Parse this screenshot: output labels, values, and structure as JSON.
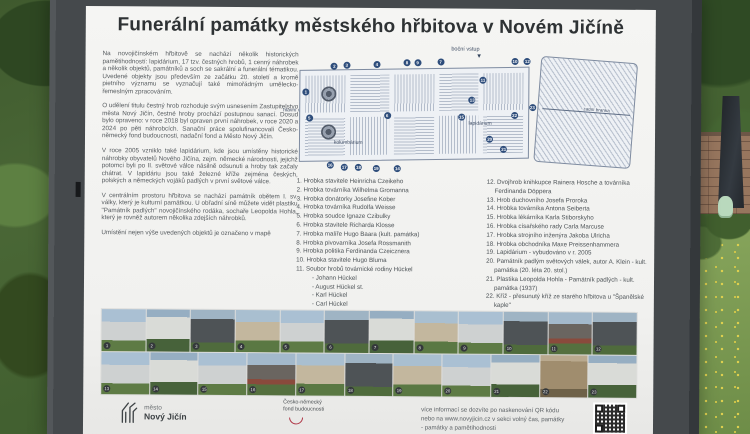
{
  "title": "Funerální památky městského hřbitova v Novém Jičíně",
  "intro": {
    "p1": "Na novojičínském hřbitově se nachází několik historických pamětihodností: lapidárium, 17 tzv. čestných hrobů, 1 cenný náhrobek a několik objektů, památníků a soch se sakrální a funerální tématikou. Uvedené objekty jsou především ze začátku 20. století a kromě pietního významu se vyznačují také mimořádným umělecko-řemeslným zpracováním.",
    "p2": "O udělení titulu čestný hrob rozhoduje svým usnesením Zastupitelstvo města Nový Jičín, čestné hroby prochází postupnou sanací. Dosud bylo opraveno: v roce 2018 byl opraven první náhrobek, v roce 2020 a 2024 po pěti náhrobcích. Sanační práce spolufinancovali Česko-německý fond budoucnosti, nadační fond a Město Nový Jičín.",
    "p3": "V roce 2005 vzniklo také lapidárium, kde jsou umístěny historické náhrobky obyvatelů Nového Jičína, zejm. německé národnosti, jejichž potomci byli po II. světové válce násilně odsunuti a hroby tak začaly chátrat. V lapidáriu jsou také železné kříže zejména českých, polských a německých vojáků padlých v první světové válce.",
    "p4": "V centrálním prostoru hřbitova se nachází památník obětem I. sv. války, který je kulturní památkou. U obřadní síně můžete vidět plastiku \"Památník padlých\" novojičínského rodáka, sochaře Leopolda Hohla, který je rovněž autorem několika zdejších náhrobků.",
    "p5": "Umístění nejen výše uvedených objektů je označeno v mapě"
  },
  "legend_left": [
    "1. Hrobka stavitele Heinricha Czeikeho",
    "2. Hrobka továrníka Wilhelma Gromanna",
    "3. Hrobka donátorky Josefine Kober",
    "4. Hrobka továrníka Rudolfa Weisse",
    "5. Hrobka soudce Ignaze Czibulky",
    "6. Hrobka stavitele Richarda Klosse",
    "7. Hrobka malíře Hugo Baara (kult. památka)",
    "8. Hrobka pivovarníka Josefa Rossmanith",
    "9. Hrobka politika Ferdinanda Czeicznera",
    "10. Hrobka stavitele Hugo Bluma",
    "11. Soubor hrobů továrnické rodiny Hückel",
    "- Johann Hückel",
    "- August Hückel st.",
    "- Karl Hückel",
    "- Carl Hückel"
  ],
  "legend_right": [
    "12. Dvojhrob knihkupce Rainera Hosche a továrníka Ferdinanda Döppera",
    "13. Hrob duchovního Josefa Proroka",
    "14. Hrobka továrníka Antona Seiberta",
    "15. Hrobka lékárníka Karla Stiborskyho",
    "16. Hrobka císařského rady Carla Marcuse",
    "17. Hrobka strojního inženýra Jakoba Ulricha",
    "18. Hrobka obchodníka Maxe Preissenhammera",
    "19. Lapidárium - vybudováno v r. 2005",
    "20. Památník padlým světových válek, autor A. Klein - kult. památka (20. léta 20. stol.)",
    "21. Plastika Leopolda Hohla - Památník padlých - kult. památka (1937)",
    "22. Kříž - přesunutý kříž ze starého hřbitova u \"Španělské kaple\"",
    "23. Kříž s lucernou v centrální ose hřbitova (1890)"
  ],
  "map": {
    "labels": {
      "side_entrance": "boční vstup",
      "main_entrance": "hlavní vstup",
      "columbarium": "kolumbárium",
      "lapidarium": "lapidárium",
      "back_gate": "zadní branka"
    },
    "markers": [
      {
        "n": 1,
        "x": 2,
        "y": 30
      },
      {
        "n": 2,
        "x": 10,
        "y": 9
      },
      {
        "n": 3,
        "x": 13.5,
        "y": 8
      },
      {
        "n": 4,
        "x": 22,
        "y": 7
      },
      {
        "n": 8,
        "x": 30.5,
        "y": 6
      },
      {
        "n": 9,
        "x": 33.5,
        "y": 6
      },
      {
        "n": 7,
        "x": 40,
        "y": 5
      },
      {
        "n": 10,
        "x": 61,
        "y": 4
      },
      {
        "n": 12,
        "x": 64.5,
        "y": 4
      },
      {
        "n": 5,
        "x": 3,
        "y": 52
      },
      {
        "n": 6,
        "x": 25,
        "y": 49
      },
      {
        "n": 11,
        "x": 52,
        "y": 20
      },
      {
        "n": 13,
        "x": 49,
        "y": 36
      },
      {
        "n": 15,
        "x": 46,
        "y": 50
      },
      {
        "n": 20,
        "x": 54,
        "y": 68
      },
      {
        "n": 21,
        "x": 58,
        "y": 76
      },
      {
        "n": 22,
        "x": 61,
        "y": 48
      },
      {
        "n": 23,
        "x": 66,
        "y": 42
      },
      {
        "n": 16,
        "x": 9,
        "y": 90
      },
      {
        "n": 17,
        "x": 13,
        "y": 92
      },
      {
        "n": 18,
        "x": 17,
        "y": 92
      },
      {
        "n": 19,
        "x": 22,
        "y": 93
      },
      {
        "n": 14,
        "x": 28,
        "y": 93
      }
    ]
  },
  "photo_numbers": {
    "row1": [
      1,
      2,
      3,
      4,
      5,
      6,
      7,
      8,
      9,
      10,
      11,
      12
    ],
    "row2": [
      13,
      14,
      15,
      16,
      17,
      18,
      19,
      20,
      21,
      22,
      23
    ]
  },
  "footer": {
    "city_label": "město",
    "city_name": "Nový Jičín",
    "fund_line1": "Česko-německý",
    "fund_line2": "fond budoucnosti",
    "info_line1": "více informací se dozvíte po naskenování QR kódu",
    "info_line2": "nebo na www.novyjicin.cz v sekci volný čas, památky",
    "info_line3": "- památky a pamětihodnosti"
  }
}
